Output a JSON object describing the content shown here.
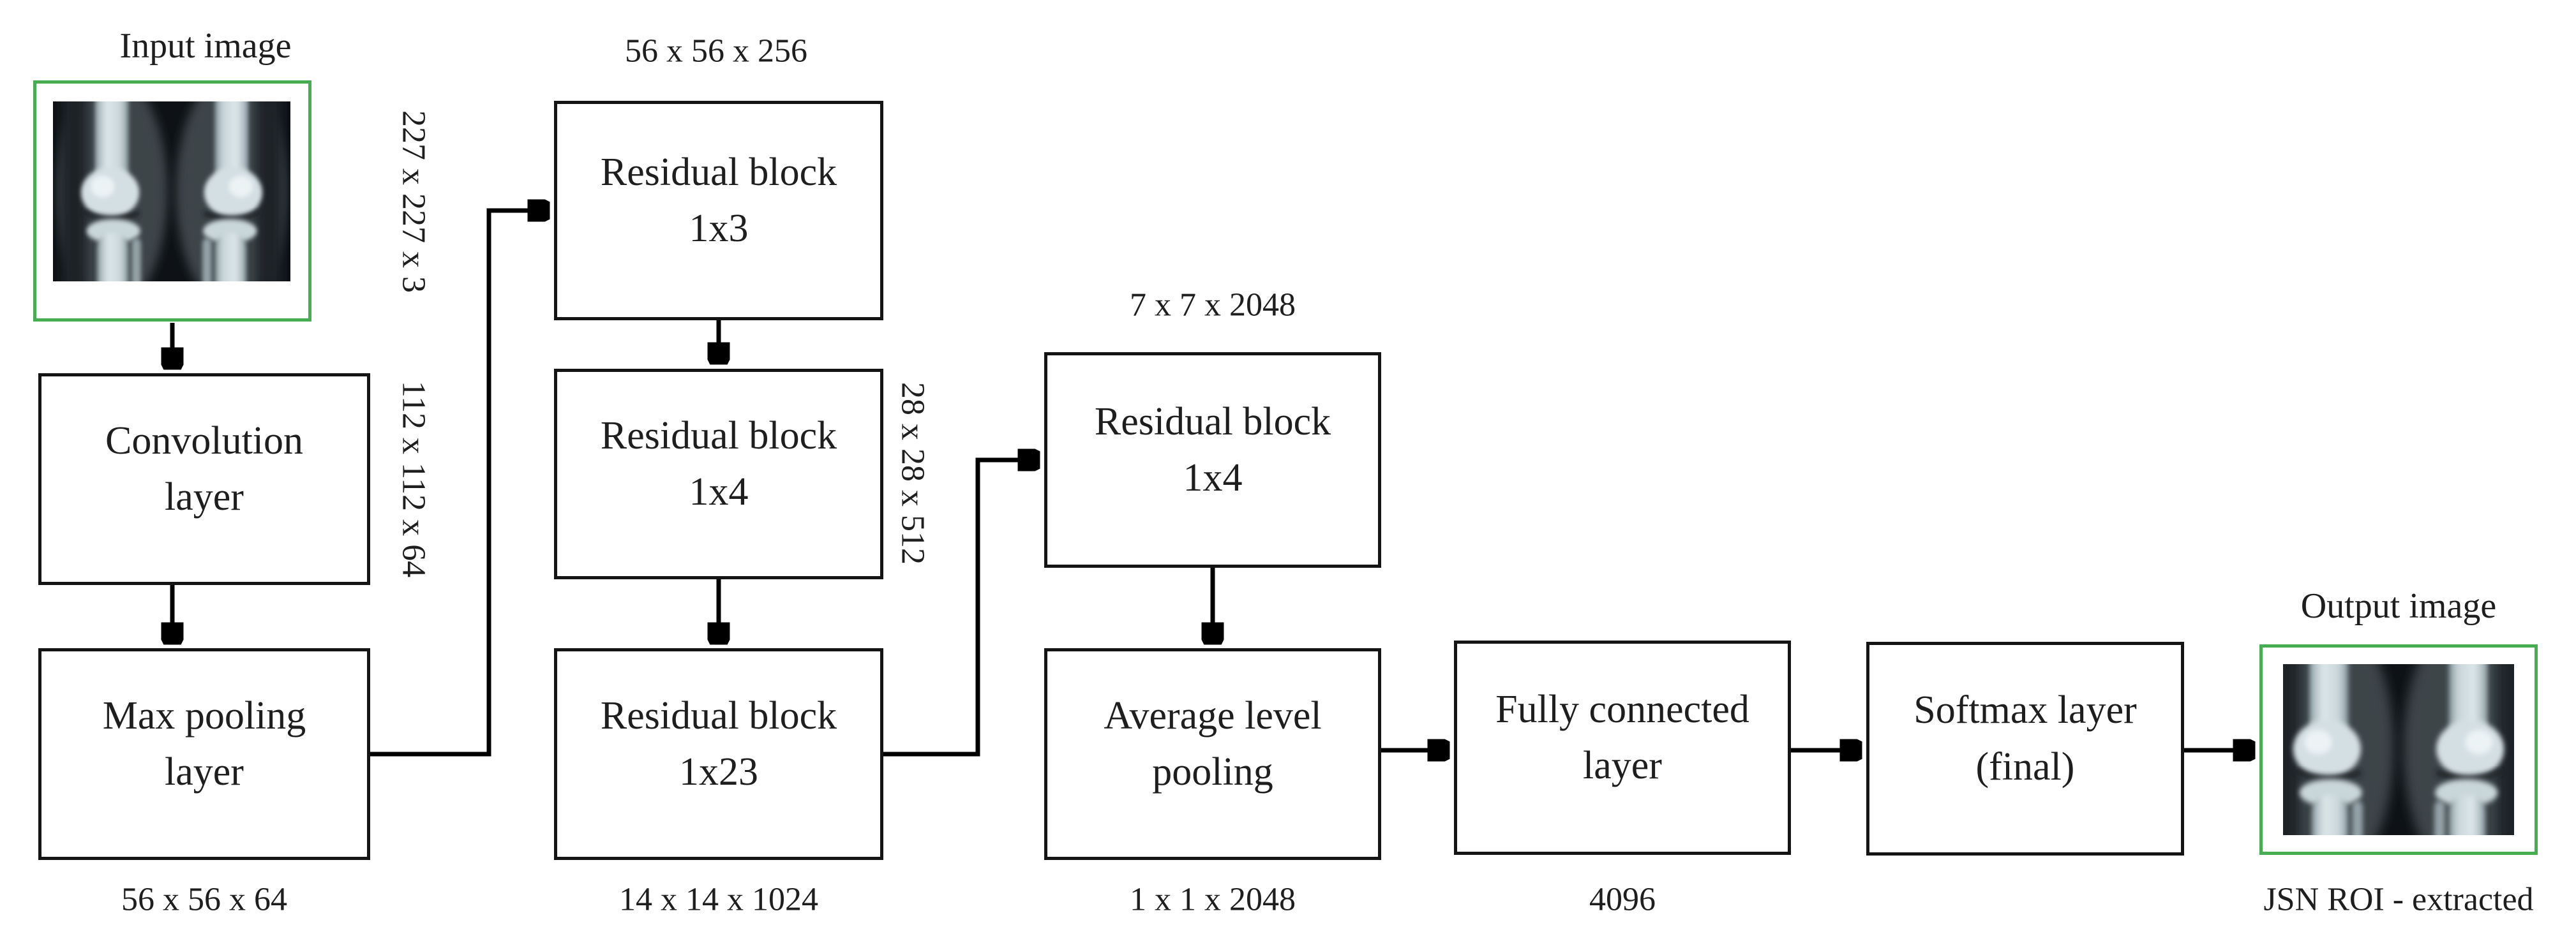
{
  "diagram": {
    "input": {
      "title": "Input image",
      "dim": "227 x 227 x 3"
    },
    "conv": {
      "label": "Convolution\nlayer",
      "dim": "112 x 112 x 64"
    },
    "maxpool": {
      "label": "Max pooling\nlayer",
      "dim": "56 x 56 x 64"
    },
    "res1": {
      "label": "Residual block\n1x3",
      "dim": "56 x 56 x 256"
    },
    "res2": {
      "label": "Residual block\n1x4",
      "dim": "28 x 28 x 512"
    },
    "res3": {
      "label": "Residual block\n1x23",
      "dim": "14 x 14 x 1024"
    },
    "res4": {
      "label": "Residual block\n1x4",
      "dim": "7 x 7 x 2048"
    },
    "avgpool": {
      "label": "Average level\npooling",
      "dim": "1 x 1 x 2048"
    },
    "fc": {
      "label": "Fully connected\nlayer",
      "dim": "4096"
    },
    "softmax": {
      "label": "Softmax layer\n(final)"
    },
    "output": {
      "title": "Output image",
      "caption": "JSN ROI - extracted"
    }
  },
  "colors": {
    "image_border_green": "#46ad50",
    "box_border": "#141414",
    "text": "#1e1e1e",
    "arrow": "#000000"
  }
}
